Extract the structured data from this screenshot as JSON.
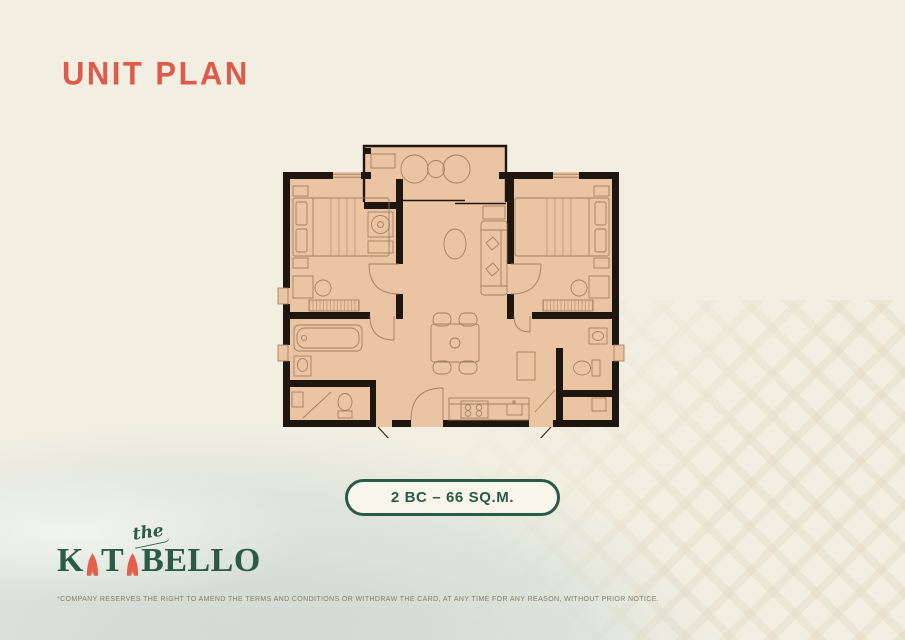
{
  "page": {
    "title": "UNIT PLAN"
  },
  "unit_badge": {
    "label": "2 BC – 66 SQ.M."
  },
  "logo": {
    "the": "the",
    "k": "K",
    "t": "T",
    "bello": "BELLO"
  },
  "disclaimer": "*COMPANY RESERVES THE RIGHT TO AMEND THE TERMS AND CONDITIONS OR WITHDRAW THE CARD, AT ANY TIME FOR ANY REASON, WITHOUT PRIOR NOTICE.",
  "colors": {
    "cream": "#F2EEE2",
    "title": "#DF5A4A",
    "green": "#2B5B46",
    "coral": "#E4604C",
    "floor": "#EBC4A4",
    "wall": "#201610",
    "line": "#9B7A5A",
    "water": "#D8E1D9",
    "pattern": "#E7E0CD",
    "badge_bg": "#F8F5EB",
    "disclaimer": "#807D6C"
  }
}
